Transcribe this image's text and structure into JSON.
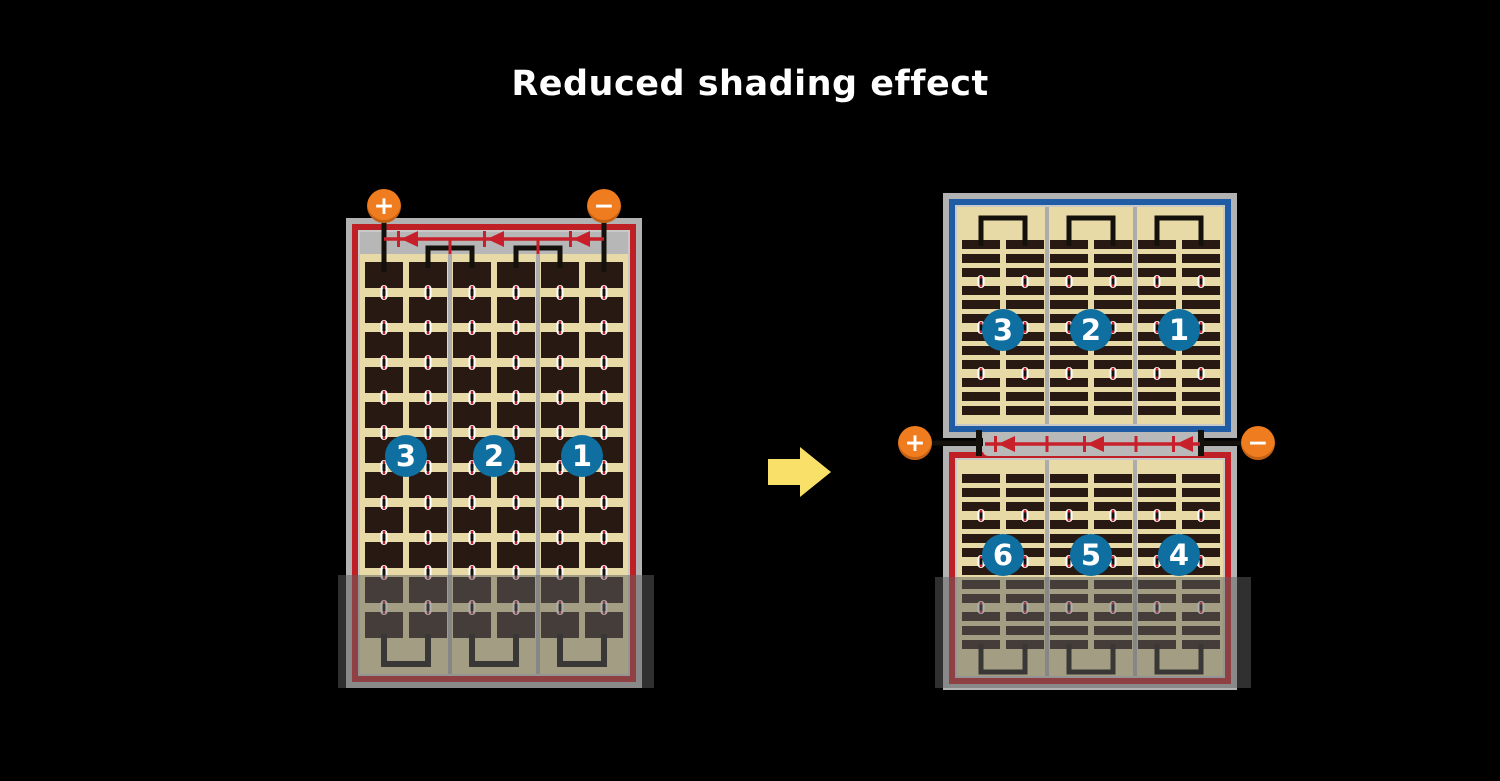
{
  "title": "Reduced shading effect",
  "colors": {
    "background": "#000000",
    "panel_frame": "#b2b2b2",
    "junction_gray": "#b9b9b9",
    "panel_red": "#be2026",
    "panel_blue": "#205ca4",
    "inner_line": "#c9c9c9",
    "inner_top_band": "#b7b7b7",
    "cell_tan": "#e7daa6",
    "cell_dark": "#281a12",
    "divider": "#acacac",
    "wire_black": "#14100c",
    "bus_red": "#c8202a",
    "dot_red": "#c8202a",
    "dot_white": "#ffffff",
    "circle_blue": "#0f6fa1",
    "terminal_orange": "#ef7c1f",
    "arrow_yellow": "#f9e169",
    "shade": "rgba(95,95,95,0.5)"
  },
  "left_module": {
    "terminals": [
      {
        "sign": "+"
      },
      {
        "sign": "−"
      }
    ],
    "strings": [
      "3",
      "2",
      "1"
    ],
    "diode_count": 3
  },
  "right_module": {
    "terminals": [
      {
        "sign": "+"
      },
      {
        "sign": "−"
      }
    ],
    "top_strings": [
      "3",
      "2",
      "1"
    ],
    "bottom_strings": [
      "6",
      "5",
      "4"
    ],
    "diode_count": 3
  },
  "arrow": {
    "direction": "right"
  }
}
